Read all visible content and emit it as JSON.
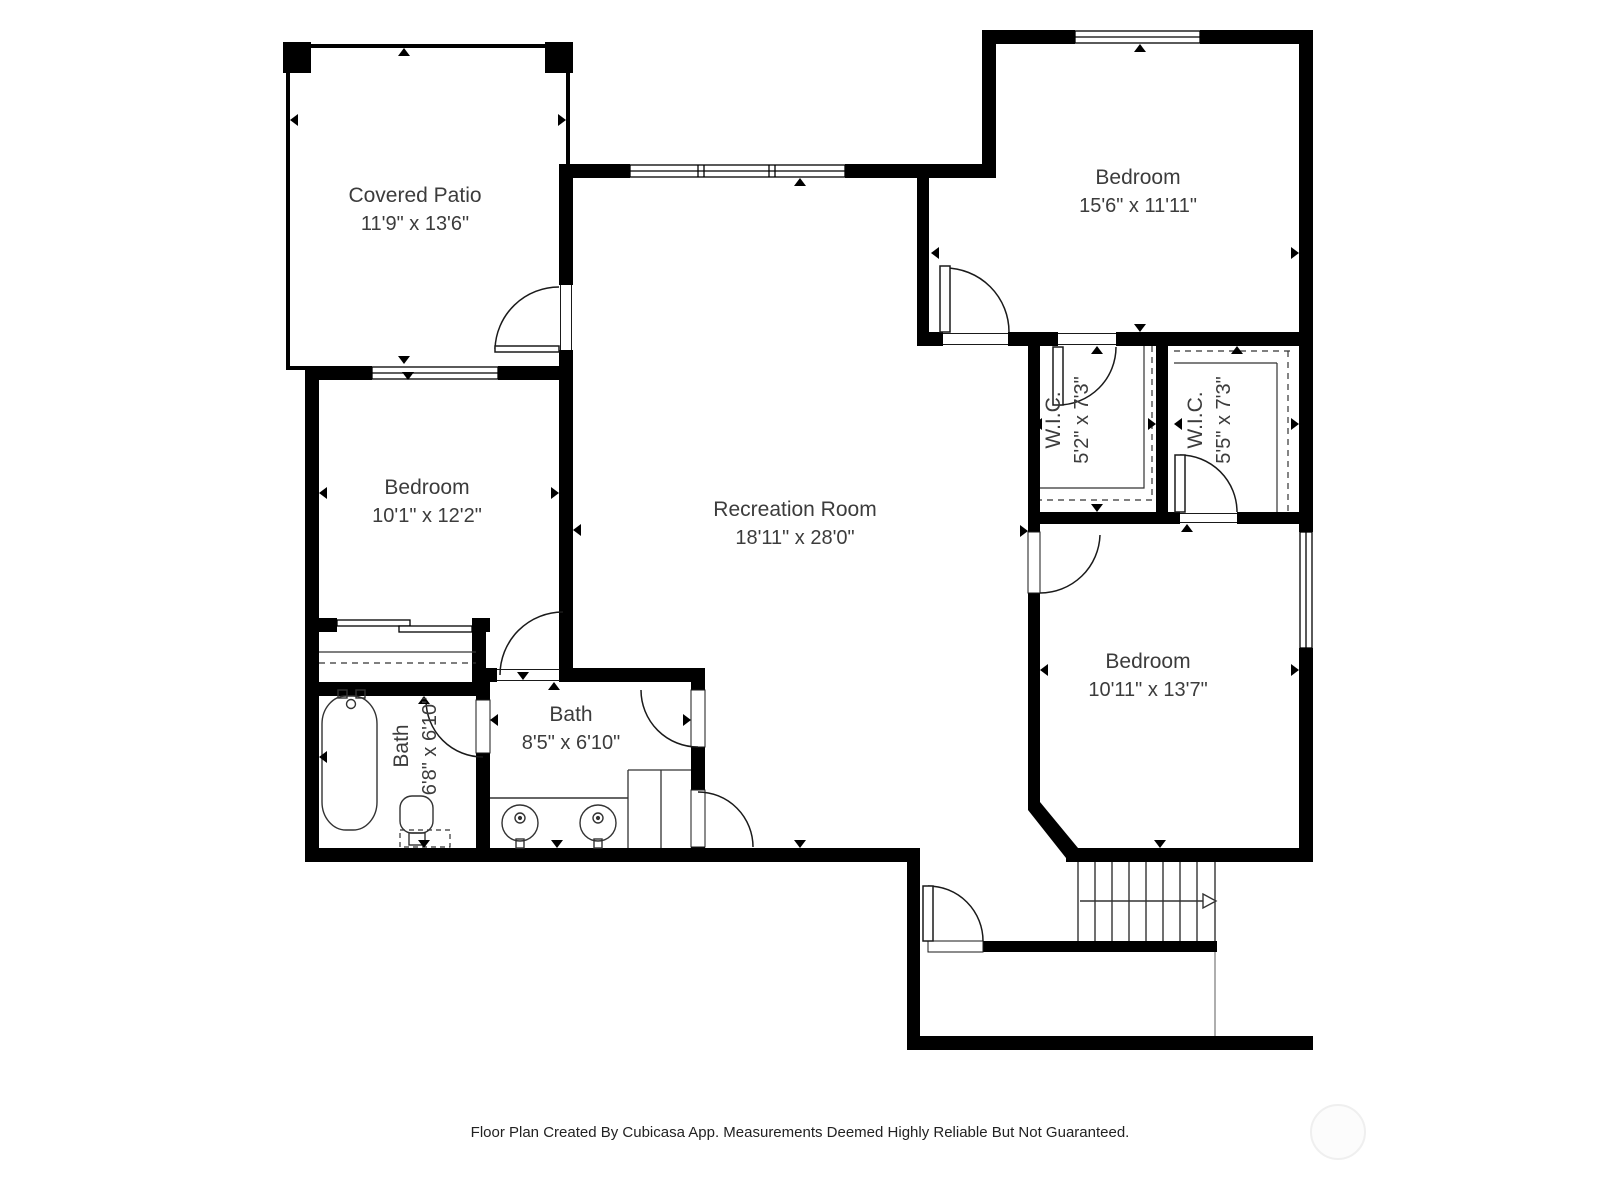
{
  "rooms": {
    "covered_patio": {
      "name": "Covered Patio",
      "dims": "11'9\" x 13'6\""
    },
    "bedroom_top_right": {
      "name": "Bedroom",
      "dims": "15'6\" x 11'11\""
    },
    "bedroom_left": {
      "name": "Bedroom",
      "dims": "10'1\" x 12'2\""
    },
    "recreation_room": {
      "name": "Recreation Room",
      "dims": "18'11\" x 28'0\""
    },
    "wic_left": {
      "name": "W.I.C.",
      "dims": "5'2\" x 7'3\""
    },
    "wic_right": {
      "name": "W.I.C.",
      "dims": "5'5\" x 7'3\""
    },
    "bedroom_bottom_right": {
      "name": "Bedroom",
      "dims": "10'11\" x 13'7\""
    },
    "bath_left": {
      "name": "Bath",
      "dims": "6'8\" x 6'10\""
    },
    "bath_middle": {
      "name": "Bath",
      "dims": "8'5\" x 6'10\""
    }
  },
  "footer": {
    "disclaimer": "Floor Plan Created By Cubicasa App. Measurements Deemed Highly Reliable But Not Guaranteed."
  },
  "colors": {
    "wall": "#000000",
    "background": "#ffffff",
    "label_text": "#3c3c3c"
  }
}
